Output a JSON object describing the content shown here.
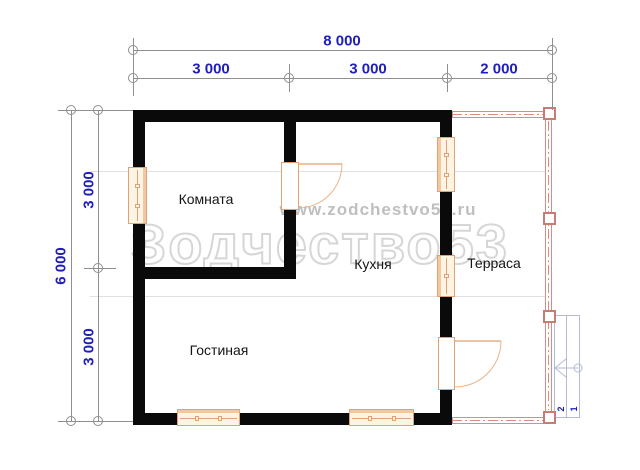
{
  "watermark": {
    "url_text": "www.zodchestvo53.ru",
    "brand_text": "Зодчество53"
  },
  "dimensions": {
    "top_total": "8 000",
    "top_segments": [
      "3 000",
      "3 000",
      "2 000"
    ],
    "left_total": "6 000",
    "left_segments": [
      "3 000",
      "3 000"
    ]
  },
  "rooms": [
    {
      "label": "Комната"
    },
    {
      "label": "Кухня"
    },
    {
      "label": "Терраса"
    },
    {
      "label": "Гостиная"
    }
  ],
  "stairs": {
    "steps": [
      "2",
      "1"
    ]
  },
  "colors": {
    "wall": "#0a0a0a",
    "dimension_text": "#2020b8",
    "dimension_line": "#8f8f8f",
    "window_outline": "#dfa276",
    "door_outline": "#e2a173",
    "terrace_outline": "#d98b84",
    "stairs_outline": "#b6b9d8",
    "watermark_gray": "#c8c8c8"
  }
}
